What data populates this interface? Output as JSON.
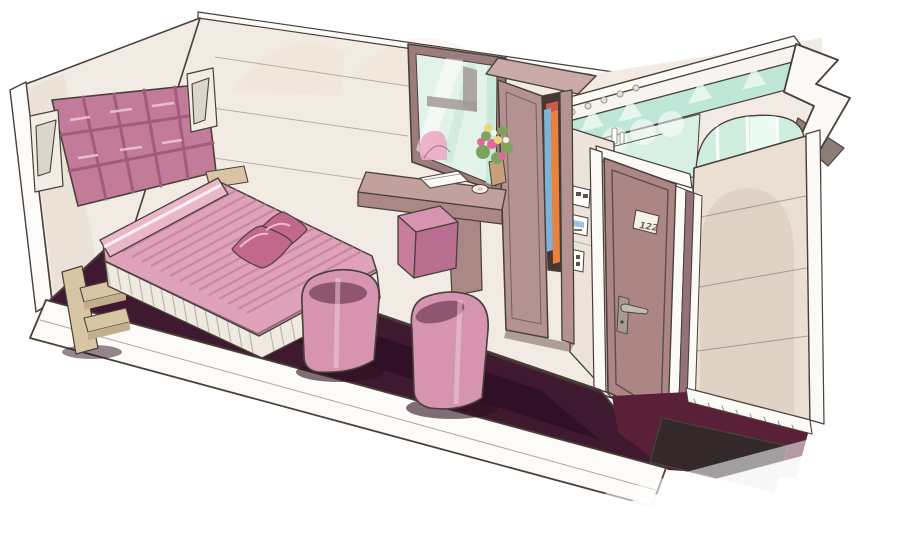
{
  "image": {
    "kind": "hand-drawn marker rendering",
    "subject": "hotel guest room interior shown in cutaway perspective with pink decor",
    "width_px": 900,
    "height_px": 549
  },
  "door": {
    "plaque_text": "122"
  },
  "scene_elements": [
    "head-wall",
    "back-wall",
    "wall-sconces",
    "tufted-headboard",
    "double-bed",
    "pillows",
    "bedside-shelves",
    "plum-carpet",
    "tub-chairs",
    "cube-ottoman",
    "desk",
    "notebook",
    "dish",
    "flower-bouquet",
    "window",
    "wardrobe",
    "hanging-clothes",
    "switch-panels",
    "entry-door",
    "door-handle",
    "room-number-plaque",
    "bathroom-glass-walls",
    "arched-window",
    "toiletry-bottles",
    "entry-mat",
    "floor-cut-edge"
  ],
  "palette": {
    "background": "#ffffff",
    "ink": "#4a4039",
    "wall_cream": "#f2ebe3",
    "wall_warm": "#ecddcb",
    "wall_shadow": "#e6dcd0",
    "headboard_pink": "#c37b9a",
    "headboard_seam": "#a05c7d",
    "bedspread_pink": "#dfa2ba",
    "bedspread_stripe": "#c27d9a",
    "bedskirt_ivory": "#efeae1",
    "pillow_pink": "#c2688d",
    "bolster_pink": "#e9b6ca",
    "carpet_plum": "#3f1930",
    "carpet_center": "#2d0f22",
    "chair_pink": "#d694b0",
    "chair_seat": "#8f5672",
    "nightstand_tan": "#d8c5a4",
    "nightstand_front": "#c3ad8a",
    "desk_top": "#c2a09e",
    "desk_face": "#ab8786",
    "window_frame": "#9d7c7e",
    "window_glass": "#e4f3ea",
    "glass_streak": "#c2e6d4",
    "mullion_gray": "#a39a94",
    "reflection_pink": "#eeaac6",
    "flower_green": "#7ca45e",
    "flower_pink": "#e0699b",
    "flower_yellow": "#ead775",
    "vase_tan": "#c9a07a",
    "wardrobe_top": "#c9aaa8",
    "wardrobe_mauve": "#b59292",
    "wardrobe_interior": "#463634",
    "clothes_blue": "#7fb3d6",
    "clothes_orange": "#e8823e",
    "clothes_red": "#c85a50",
    "switch_wall": "#ece4da",
    "screen_blue": "#9fc6dc",
    "door_mauve": "#ac8585",
    "frame_white": "#f7f4ef",
    "metal": "#c2bbb1",
    "bath_teal": "#bfe7d8",
    "bath_mint": "#d8efe3",
    "arch_glass": "#cfeede",
    "bath_wall": "#e9dfd3",
    "arch_shadow": "#d8c8b7",
    "accent_gray": "#8b7e76",
    "threshold_maroon": "#5a2038",
    "mat_dark": "#33282a",
    "paper_white": "#fcfbf8"
  }
}
